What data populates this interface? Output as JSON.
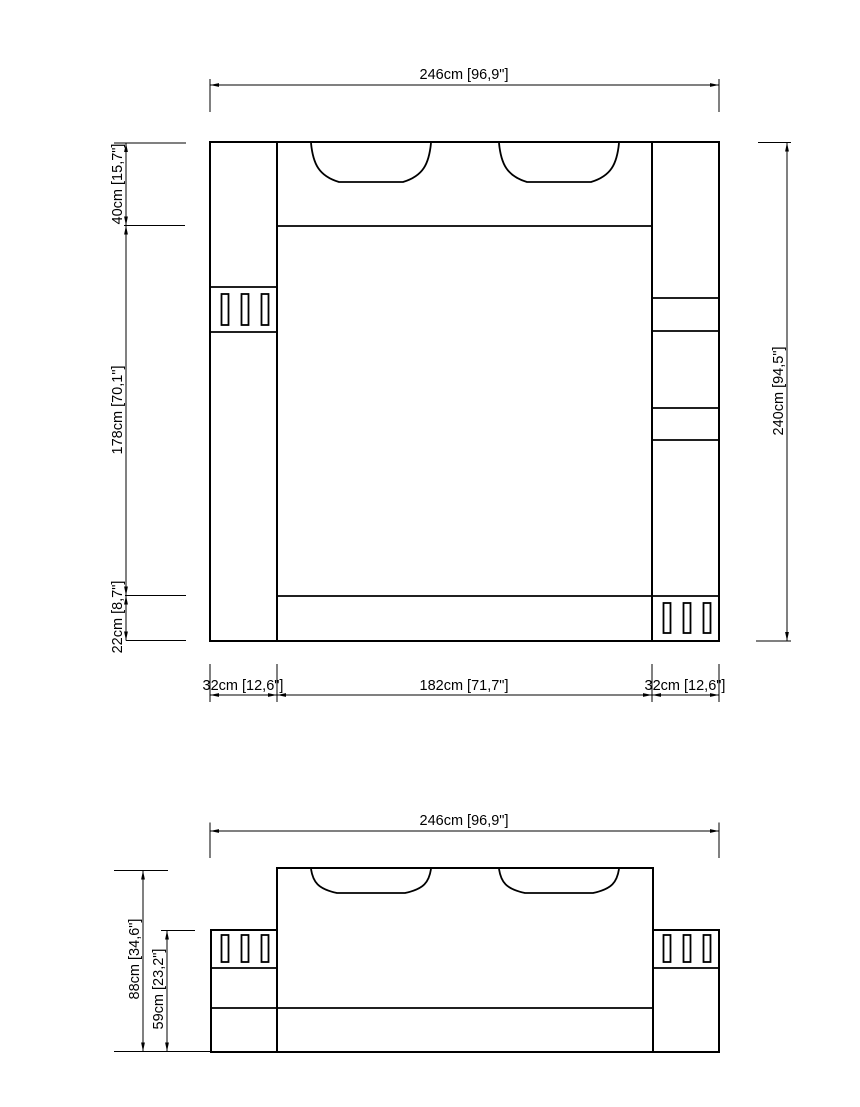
{
  "page": {
    "background": "#ffffff",
    "line_color": "#000000"
  },
  "views": {
    "plan": {
      "dim_width_top": "246cm [96,9\"]",
      "dim_height_right": "240cm [94,5\"]",
      "dim_headboard_depth": "40cm [15,7\"]",
      "dim_bed_length": "178cm [70,1\"]",
      "dim_footboard_depth": "22cm [8,7\"]",
      "dim_bottom_left": "32cm [12,6\"]",
      "dim_bottom_center": "182cm [71,7\"]",
      "dim_bottom_right": "32cm [12,6\"]"
    },
    "front": {
      "dim_width_top": "246cm [96,9\"]",
      "dim_height_total": "88cm [34,6\"]",
      "dim_height_cabinet": "59cm [23,2\"]"
    }
  }
}
